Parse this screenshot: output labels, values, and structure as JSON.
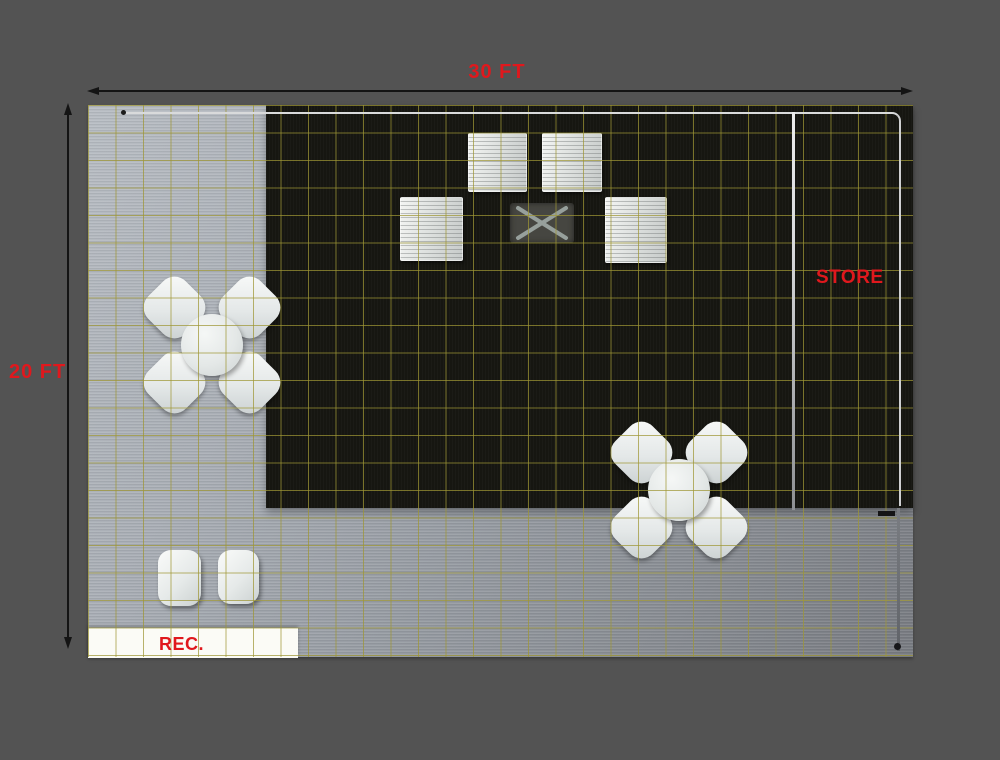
{
  "plan": {
    "title": "exhibit-booth-floor-plan",
    "width_label": "30 FT",
    "depth_label": "20 FT",
    "store_label": "STORE",
    "reception_label": "REC."
  },
  "colors": {
    "background": "#535353",
    "label_red": "#e0181d",
    "dimension_line": "#141414",
    "grid_olive": "#9e9634",
    "carpet_dark": "#161611",
    "floor_light": "#a9aeb5",
    "wall_white": "#d9dadb",
    "furniture_white": "#eef0ef",
    "cross_table_gray": "#464641"
  },
  "furniture": {
    "shelf_unit_count": 4,
    "meeting_table_sets": 2,
    "chairs_per_set": 4,
    "stool_count": 2,
    "cross_table_count": 1,
    "reception_counter_count": 1
  }
}
